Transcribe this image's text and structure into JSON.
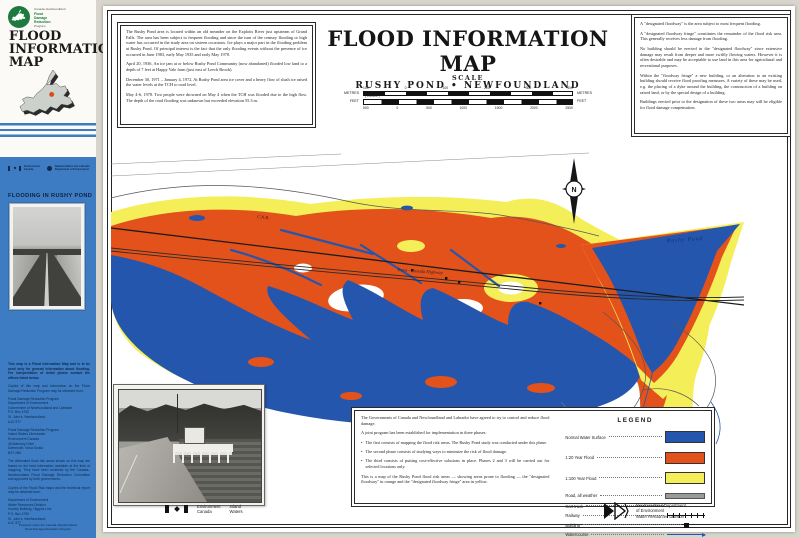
{
  "colors": {
    "page-bg": "#d8d5cc",
    "paper": "#ffffff",
    "sidebar-blue": "#3d7cc2",
    "water-blue": "#2456ad",
    "flood-orange": "#e4521b",
    "fringe-yellow": "#f4ee58",
    "logo-green": "#1e7a3e",
    "marker-red": "#d84a1b"
  },
  "sidebar": {
    "program": {
      "name_small": "Canada–Newfoundland",
      "line1": "Flood",
      "line2": "Damage",
      "line3": "Reduction",
      "name_small2": "Program"
    },
    "title_lines": [
      "FLOOD",
      "INFORMATION",
      "MAP"
    ],
    "location": "RUSHY POND",
    "gov_logos": {
      "left1": "Environment",
      "left2": "Canada",
      "right1": "Newfoundland and Labrador",
      "right2": "Department of Environment"
    },
    "flooding_heading": "FLOODING IN RUSHY POND",
    "paragraphs": [
      "This map is a Flood Information Map and is to be used only for general information about flooding. For interpretation of detail please contact the offices listed below.",
      "Copies of this map and information on the Flood Damage Reduction Program may be obtained from:",
      "Flood Damage Reduction Program\nDepartment of Environment\nGovernment of Newfoundland and Labrador\nP.O. Box 4750\nSt. John's, Newfoundland\nA1C 5T7",
      "Flood Damage Reduction Program\nInland Waters Directorate\nEnvironment Canada\n45 Alderney Drive\nDartmouth, Nova Scotia\nB2Y 2N6",
      "The delineated flood risk areas shown on this map are based on the best information available at the time of mapping. They have been reviewed by the Canada–Newfoundland Flood Damage Reduction Committee and approved by both governments.",
      "Copies of the Flood Risk maps and the technical report may be obtained from:",
      "Department of Environment\nWater Resources Division\nHowley Building, Higgins Line\nP.O. Box 4750\nSt. John's, Newfoundland\nA1C 5T7"
    ],
    "caption_line1": "Prepared under the Canada–Newfoundland",
    "caption_line2": "Flood Damage Reduction Program"
  },
  "header": {
    "title": "FLOOD INFORMATION MAP",
    "subtitle": "RUSHY POND • NEWFOUNDLAND",
    "scale_label": "SCALE",
    "metres_unit": "METRES",
    "feet_unit": "FEET",
    "ratio": "( 1:4,800 )",
    "metres_ticks": [
      "100",
      "0",
      "100",
      "200",
      "300",
      "400"
    ],
    "feet_ticks": [
      "500",
      "0",
      "500",
      "1000",
      "1500",
      "2000",
      "2500"
    ]
  },
  "info_left": {
    "paragraphs": [
      "The Rushy Pond area is located within an old meander on the Exploits River just upstream of Grand Falls. The area has been subject to frequent flooding and since the turn of the century flooding or high water has occurred in the study area on sixteen occasions. Ice plays a major part in the flooding problem at Rushy Pond. Of principal interest is the fact that the only flooding events without the presence of ice occurred in June 1983, early May 1935 and early May 1978.",
      "April 20, 1936. An ice jam at or below Rushy Pond Community (now abandoned) flooded low land to a depth of 7 feet at Happy Vale farm (just east of Leech Brook).",
      "December 30, 1971 – January 4, 1972. At Rushy Pond area ice cover and a heavy flow of slush ice raised the water levels at the TCH to road level.",
      "May 4-6, 1978. Two people were drowned on May 4 when the TCH was flooded due to the high flow. The depth of the road flooding was unknown but exceeded elevation 55.3 m."
    ]
  },
  "info_right": {
    "paragraphs": [
      "A \"designated floodway\" is the area subject to most frequent flooding.",
      "A \"designated floodway fringe\" constitutes the remainder of the flood risk area. This generally receives less damage from flooding.",
      "No building should be erected in the \"designated floodway\" since extensive damage may result from deeper and more swiftly flowing waters. However it is often desirable and may be acceptable to use land in this area for agricultural and recreational purposes.",
      "Within the \"floodway fringe\" a new building, or an alteration to an existing building should receive flood proofing measures. A variety of these may be used, e.g. the placing of a dyke around the building, the construction of a building on raised land, or by the special design of a building.",
      "Buildings erected prior to the designation of these two areas may still be eligible for flood damage compensation."
    ]
  },
  "program_box": {
    "p1": "The Governments of Canada and Newfoundland and Labrador have agreed to try to control and reduce flood damage.",
    "p2": "A joint program has been established for implementation in three phases:",
    "bullets": [
      "The first consists of mapping the flood risk areas. The Rushy Pond study was conducted under this phase.",
      "The second phase consists of studying ways to minimize the risk of flood damage.",
      "The third consists of putting cost-effective solutions in place. Phases 2 and 3 will be carried out for selected locations only."
    ],
    "p3": "This is a map of the Rushy Pond flood risk areas — showing areas prone to flooding — the \"designated floodway\" in orange and the \"designated floodway fringe\" area in yellow."
  },
  "legend": {
    "title": "LEGEND",
    "items": [
      {
        "label": "Normal Water Surface",
        "swatch": "water-blue-fill"
      },
      {
        "label": "1:20 Year Flood",
        "swatch": "flood-orange-fill"
      },
      {
        "label": "1:100 Year Flood",
        "swatch": "fringe-yellow-fill"
      },
      {
        "label": "Road, all weather",
        "swatch": "gray-road-bar"
      },
      {
        "label": "Cart track",
        "swatch": "dashed-line"
      },
      {
        "label": "Railway",
        "swatch": "ticked-line"
      },
      {
        "label": "Building",
        "swatch": "black-square"
      },
      {
        "label": "Watercourse",
        "swatch": "blue-arrow"
      }
    ]
  },
  "map": {
    "pond_label": "Rushy Pond",
    "railway_label": "C.N.R.",
    "highway_label": "Trans - Canada Highway",
    "north": "N"
  },
  "footer": {
    "env1": "Environment",
    "env2": "Canada",
    "inland1": "Inland",
    "inland2": "Waters",
    "nfld1": "Newfoundland Department",
    "nfld2": "of Environment",
    "nfld3": "Water Resources Division"
  }
}
